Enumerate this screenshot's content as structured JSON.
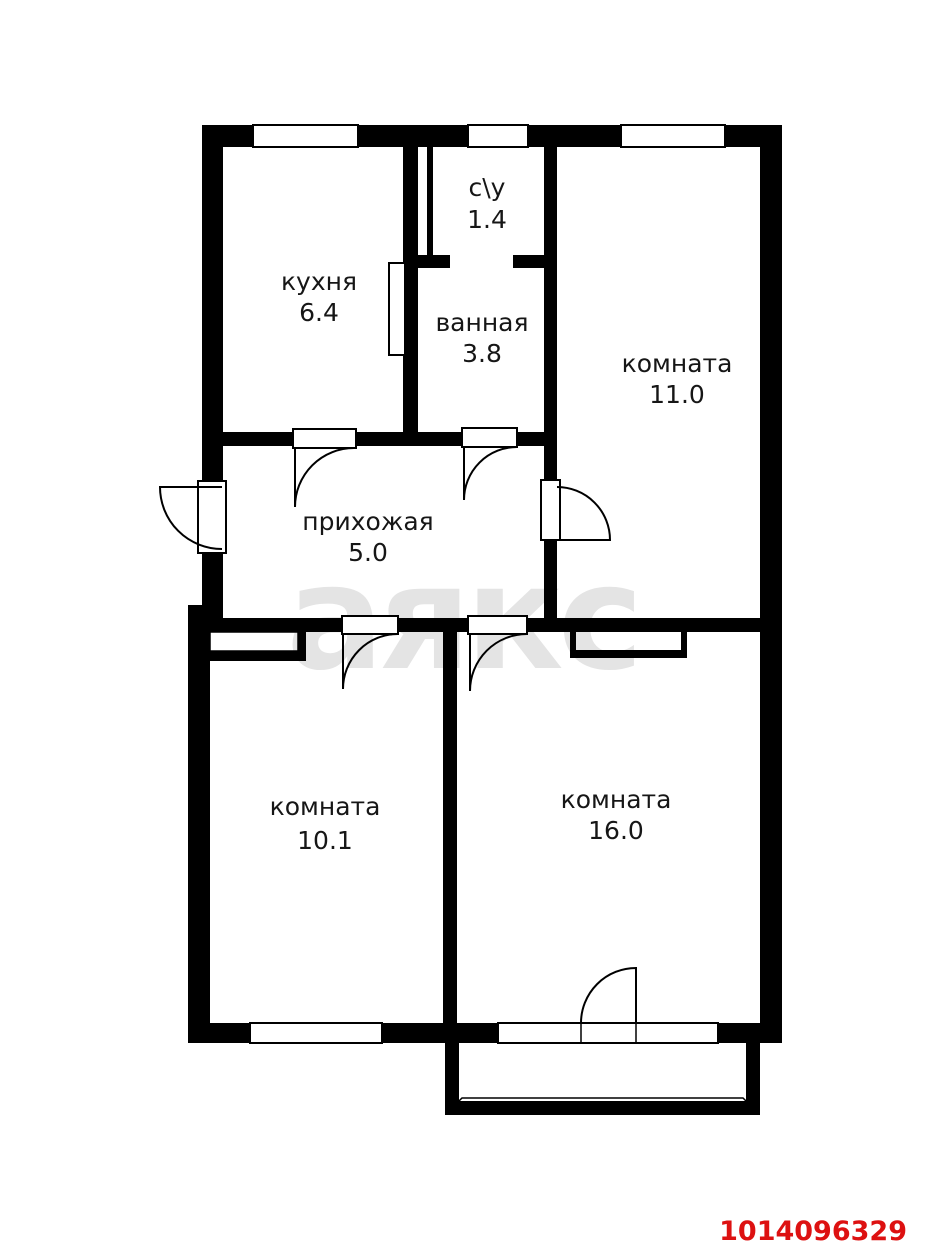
{
  "rooms": {
    "kitchen": {
      "label": "кухня",
      "area": "6.4"
    },
    "wc": {
      "label": "с\\у",
      "area": "1.4"
    },
    "bathroom": {
      "label": "ванная",
      "area": "3.8"
    },
    "room_11": {
      "label": "комната",
      "area": "11.0"
    },
    "hallway": {
      "label": "прихожая",
      "area": "5.0"
    },
    "room_10": {
      "label": "комната",
      "area": "10.1"
    },
    "room_16": {
      "label": "комната",
      "area": "16.0"
    }
  },
  "watermark": "аякс",
  "listing_id": "1014096329",
  "colors": {
    "wall": "#000000",
    "room_fill": "#ffffff",
    "label_text": "#161616",
    "watermark": "#e4e4e4",
    "listing_id": "#dd1111"
  }
}
